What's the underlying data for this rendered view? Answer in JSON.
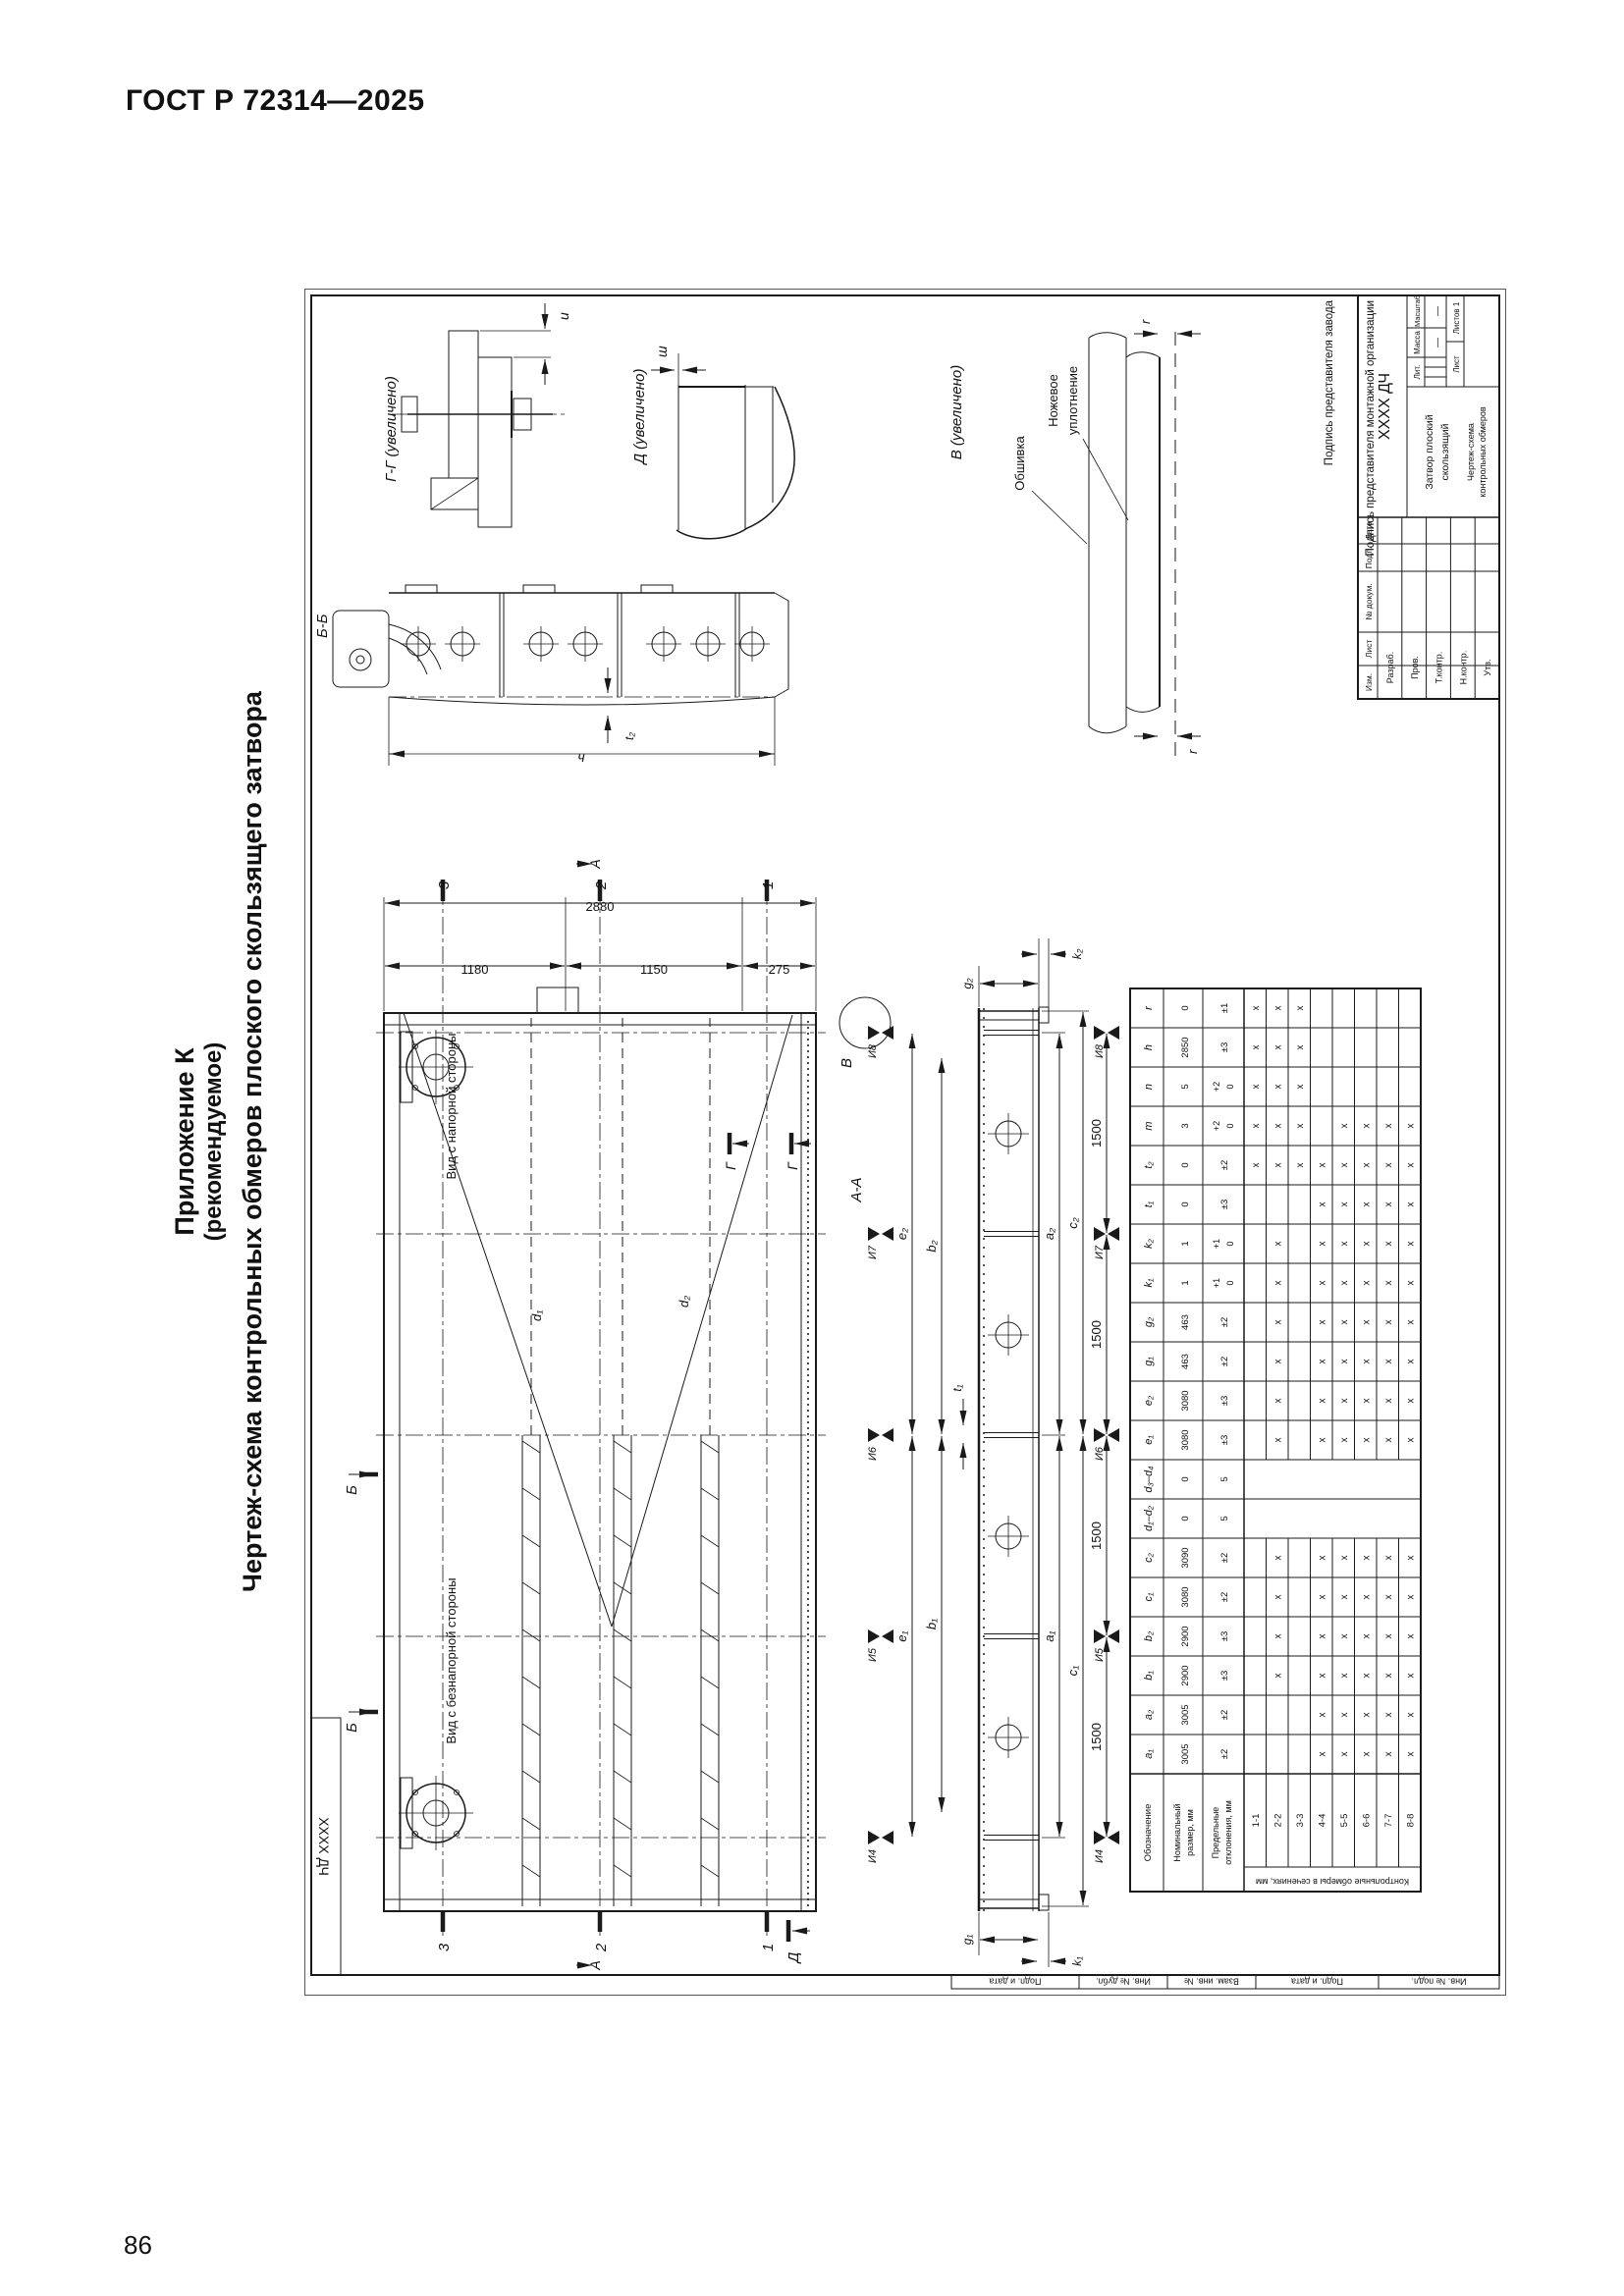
{
  "page": {
    "standard": "ГОСТ Р 72314—2025",
    "number": "86"
  },
  "appendix": {
    "line1": "Приложение К",
    "line2": "(рекомендуемое)",
    "subtitle": "Чертеж-схема контрольных обмеров плоского скользящего затвора"
  },
  "drawing": {
    "corner_code": "ХХХХ ДЧ",
    "margin_labels": [
      "Подп. и дата",
      "Инв. № дубл.",
      "Взам. инв. №",
      "Подп. и дата",
      "Инв. № подл."
    ],
    "signature_factory": "Подпись представителя завода",
    "signature_mounting": "Подпись представителя монтажной организации",
    "view_labels": {
      "pressure_side": "Вид с напорной стороны",
      "no_pressure_side": "Вид с безнапорной стороны",
      "section_aa": "А-А",
      "section_bb": "Б-Б",
      "detail_gg": "Г-Г (увеличено)",
      "detail_d": "Д (увеличено)",
      "detail_v": "В (увеличено)"
    },
    "callouts": {
      "skin": "Обшивка",
      "knife_seal_1": "Ножевое",
      "knife_seal_2": "уплотнение"
    },
    "marks": {
      "a": "А",
      "b": "Б",
      "g": "Г",
      "d": "Д",
      "v": "В",
      "s1": "1",
      "s2": "2",
      "s3": "3"
    },
    "dims": {
      "height_total": "2880",
      "height_seg1": "1180",
      "height_seg2": "1150",
      "height_seg3": "275",
      "step": "1500",
      "points": [
        "И4",
        "И5",
        "И6",
        "И7",
        "И8"
      ],
      "d1": "d₁",
      "d2": "d₂",
      "e1": "e₁",
      "e2": "e₂",
      "b1": "b₁",
      "b2": "b₂",
      "a1": "a₁",
      "a2": "a₂",
      "c1": "c₁",
      "c2": "c₂",
      "g1": "g₁",
      "g2": "g₂",
      "k1": "k₁",
      "k2": "k₂",
      "t1": "t₁",
      "t2": "t₂",
      "bb_length": "ч",
      "gg_gap": "u",
      "d_gap": "ш",
      "v_gap_left": "r",
      "v_gap_right": "r"
    }
  },
  "table": {
    "label_designation": "Обозначение",
    "label_nominal": "Номинальный размер, мм",
    "label_tolerance": "Предельные отклонения, мм",
    "label_sections": "Контрольные обмеры в сечениях, мм",
    "columns": [
      {
        "h": "a₁",
        "n": "3005",
        "t": "±2"
      },
      {
        "h": "a₂",
        "n": "3005",
        "t": "±2"
      },
      {
        "h": "b₁",
        "n": "2900",
        "t": "±3"
      },
      {
        "h": "b₂",
        "n": "2900",
        "t": "±3"
      },
      {
        "h": "c₁",
        "n": "3080",
        "t": "±2"
      },
      {
        "h": "c₂",
        "n": "3090",
        "t": "±2"
      },
      {
        "h": "d₁–d₂",
        "n": "0",
        "t": "5"
      },
      {
        "h": "d₃–d₄",
        "n": "0",
        "t": "5"
      },
      {
        "h": "e₁",
        "n": "3080",
        "t": "±3"
      },
      {
        "h": "e₂",
        "n": "3080",
        "t": "±3"
      },
      {
        "h": "g₁",
        "n": "463",
        "t": "±2"
      },
      {
        "h": "g₂",
        "n": "463",
        "t": "±2"
      },
      {
        "h": "k₁",
        "n": "1",
        "t": "+1\n0"
      },
      {
        "h": "k₂",
        "n": "1",
        "t": "+1\n0"
      },
      {
        "h": "t₁",
        "n": "0",
        "t": "±3"
      },
      {
        "h": "t₂",
        "n": "0",
        "t": "±2"
      },
      {
        "h": "m",
        "n": "3",
        "t": "+2\n0"
      },
      {
        "h": "n",
        "n": "5",
        "t": "+2\n0"
      },
      {
        "h": "h",
        "n": "2850",
        "t": "±3"
      },
      {
        "h": "r",
        "n": "0",
        "t": "±1"
      }
    ],
    "rows": [
      {
        "label": "1-1",
        "marks": [
          0,
          0,
          0,
          0,
          0,
          0,
          0,
          0,
          0,
          0,
          0,
          0,
          0,
          0,
          0,
          1,
          1,
          1,
          1,
          1
        ]
      },
      {
        "label": "2-2",
        "marks": [
          0,
          0,
          1,
          1,
          1,
          1,
          0,
          0,
          1,
          1,
          1,
          1,
          1,
          1,
          0,
          1,
          1,
          1,
          1,
          1
        ]
      },
      {
        "label": "3-3",
        "marks": [
          0,
          0,
          0,
          0,
          0,
          0,
          0,
          0,
          0,
          0,
          0,
          0,
          0,
          0,
          0,
          1,
          1,
          1,
          1,
          1
        ]
      },
      {
        "label": "4-4",
        "marks": [
          1,
          1,
          1,
          1,
          1,
          1,
          0,
          0,
          1,
          1,
          1,
          1,
          1,
          1,
          1,
          1,
          0,
          0,
          0,
          0
        ]
      },
      {
        "label": "5-5",
        "marks": [
          1,
          1,
          1,
          1,
          1,
          1,
          0,
          0,
          1,
          1,
          1,
          1,
          1,
          1,
          1,
          1,
          1,
          0,
          0,
          0
        ]
      },
      {
        "label": "6-6",
        "marks": [
          1,
          1,
          1,
          1,
          1,
          1,
          0,
          0,
          1,
          1,
          1,
          1,
          1,
          1,
          1,
          1,
          1,
          0,
          0,
          0
        ]
      },
      {
        "label": "7-7",
        "marks": [
          1,
          1,
          1,
          1,
          1,
          1,
          0,
          0,
          1,
          1,
          1,
          1,
          1,
          1,
          1,
          1,
          1,
          0,
          0,
          0
        ]
      },
      {
        "label": "8-8",
        "marks": [
          1,
          1,
          1,
          1,
          1,
          1,
          0,
          0,
          1,
          1,
          1,
          1,
          1,
          1,
          1,
          1,
          1,
          0,
          0,
          0
        ]
      }
    ]
  },
  "stamp": {
    "doc_code": "ХХХХ ДЧ",
    "name": "Затвор плоский скользящий",
    "doc_type": "Чертеж-схема контрольных обмеров",
    "header_cols": [
      "Изм.",
      "Лист",
      "№ докум.",
      "Подп.",
      "Дата"
    ],
    "role_rows": [
      "Разраб.",
      "Пров.",
      "Т.контр.",
      "Н.контр.",
      "Утв."
    ],
    "lit": "Лит.",
    "mass": "Масса",
    "scale": "Масштаб",
    "mass_value": "—",
    "scale_value": "—",
    "sheet": "Лист",
    "sheets": "Листов 1"
  }
}
